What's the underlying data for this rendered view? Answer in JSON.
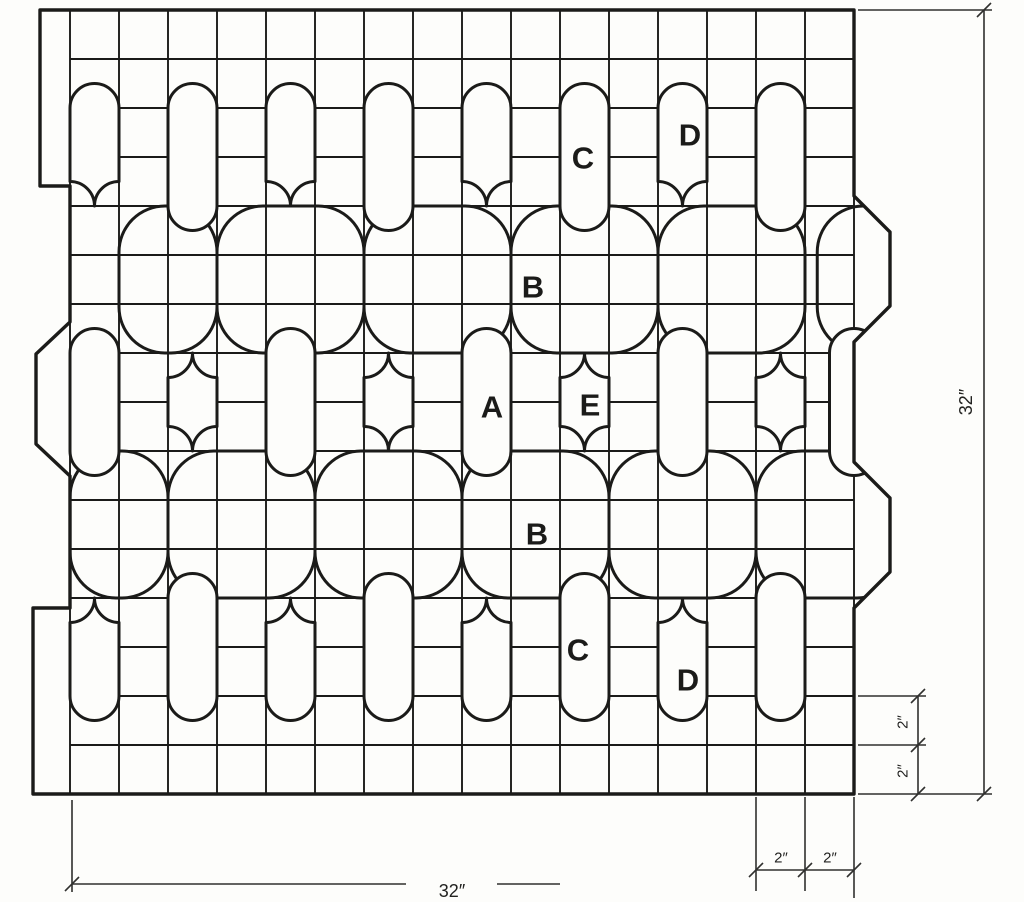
{
  "diagram": {
    "kind": "quilt-block-pattern-draft",
    "grid": {
      "columns": 16,
      "rows": 16,
      "cell_label": "2″",
      "total_width_label": "32″",
      "total_height_label": "32″"
    },
    "piece_labels": [
      {
        "id": "A",
        "text": "A",
        "x": 492,
        "y": 407
      },
      {
        "id": "B-upper",
        "text": "B",
        "x": 533,
        "y": 287
      },
      {
        "id": "B-lower",
        "text": "B",
        "x": 537,
        "y": 534
      },
      {
        "id": "C-upper",
        "text": "C",
        "x": 583,
        "y": 158
      },
      {
        "id": "C-lower",
        "text": "C",
        "x": 578,
        "y": 650
      },
      {
        "id": "D-upper",
        "text": "D",
        "x": 690,
        "y": 135
      },
      {
        "id": "D-lower",
        "text": "D",
        "x": 688,
        "y": 680
      },
      {
        "id": "E",
        "text": "E",
        "x": 590,
        "y": 405
      }
    ],
    "dimensions": [
      {
        "id": "total-width",
        "text": "32″",
        "x": 452,
        "y": 891,
        "rotate": 0,
        "size": 18
      },
      {
        "id": "total-height",
        "text": "32″",
        "x": 966,
        "y": 402,
        "rotate": -90,
        "size": 18
      },
      {
        "id": "cell-width-1",
        "text": "2″",
        "x": 781,
        "y": 858,
        "rotate": 0,
        "size": 15
      },
      {
        "id": "cell-width-2",
        "text": "2″",
        "x": 830,
        "y": 858,
        "rotate": 0,
        "size": 15
      },
      {
        "id": "cell-height-1",
        "text": "2″",
        "x": 903,
        "y": 722,
        "rotate": -90,
        "size": 15
      },
      {
        "id": "cell-height-2",
        "text": "2″",
        "x": 903,
        "y": 771,
        "rotate": -90,
        "size": 15
      }
    ],
    "pattern": {
      "origin": {
        "x": 70,
        "y": 10
      },
      "cell": 49,
      "colors": {
        "line": "#1b1b19",
        "paper": "#fdfdfb"
      },
      "outline": [
        [
          40,
          10
        ],
        [
          854,
          10
        ],
        [
          854,
          196
        ],
        [
          890,
          232
        ],
        [
          890,
          306
        ],
        [
          854,
          342
        ],
        [
          854,
          462
        ],
        [
          890,
          498
        ],
        [
          890,
          572
        ],
        [
          854,
          608
        ],
        [
          854,
          794
        ],
        [
          33,
          794
        ],
        [
          33,
          608
        ],
        [
          70,
          608
        ],
        [
          70,
          476
        ],
        [
          36,
          444
        ],
        [
          36,
          354
        ],
        [
          70,
          322
        ],
        [
          70,
          186
        ],
        [
          40,
          186
        ]
      ],
      "upper_links": [
        [
          1,
          2
        ],
        [
          3,
          3
        ],
        [
          6,
          3
        ],
        [
          9,
          3
        ],
        [
          12,
          3
        ],
        [
          15.25,
          1.9
        ]
      ],
      "lower_links": [
        [
          0,
          2
        ],
        [
          2,
          3
        ],
        [
          5,
          3
        ],
        [
          8,
          3
        ],
        [
          11,
          3
        ],
        [
          14,
          3
        ]
      ],
      "top_arches": [
        0,
        4,
        8,
        12
      ],
      "top_stadiums": [
        2,
        6,
        10,
        14
      ],
      "mid_stadiums": [
        0,
        4,
        8,
        12,
        15.5
      ],
      "mid_lenses": [
        2,
        6,
        10,
        14
      ],
      "bottom_arches": [
        0,
        4,
        8,
        12
      ],
      "bottom_stadiums": [
        2,
        6,
        10,
        14
      ],
      "dim_lines": [
        [
          858,
          10,
          992,
          10
        ],
        [
          984,
          10,
          984,
          794
        ],
        [
          858,
          794,
          992,
          794
        ],
        [
          72,
          800,
          72,
          892
        ],
        [
          72,
          884,
          406,
          884
        ],
        [
          497,
          884,
          560,
          884
        ],
        [
          756,
          797,
          756,
          891
        ],
        [
          805,
          797,
          805,
          891
        ],
        [
          854,
          797,
          854,
          898
        ],
        [
          756,
          870,
          854,
          870
        ],
        [
          858,
          696,
          926,
          696
        ],
        [
          858,
          745,
          926,
          745
        ],
        [
          918,
          696,
          918,
          794
        ]
      ],
      "dim_ticks": [
        [
          984,
          10
        ],
        [
          984,
          794
        ],
        [
          72,
          884
        ],
        [
          756,
          870
        ],
        [
          805,
          870
        ],
        [
          854,
          870
        ],
        [
          918,
          696
        ],
        [
          918,
          745
        ],
        [
          918,
          794
        ]
      ]
    }
  }
}
